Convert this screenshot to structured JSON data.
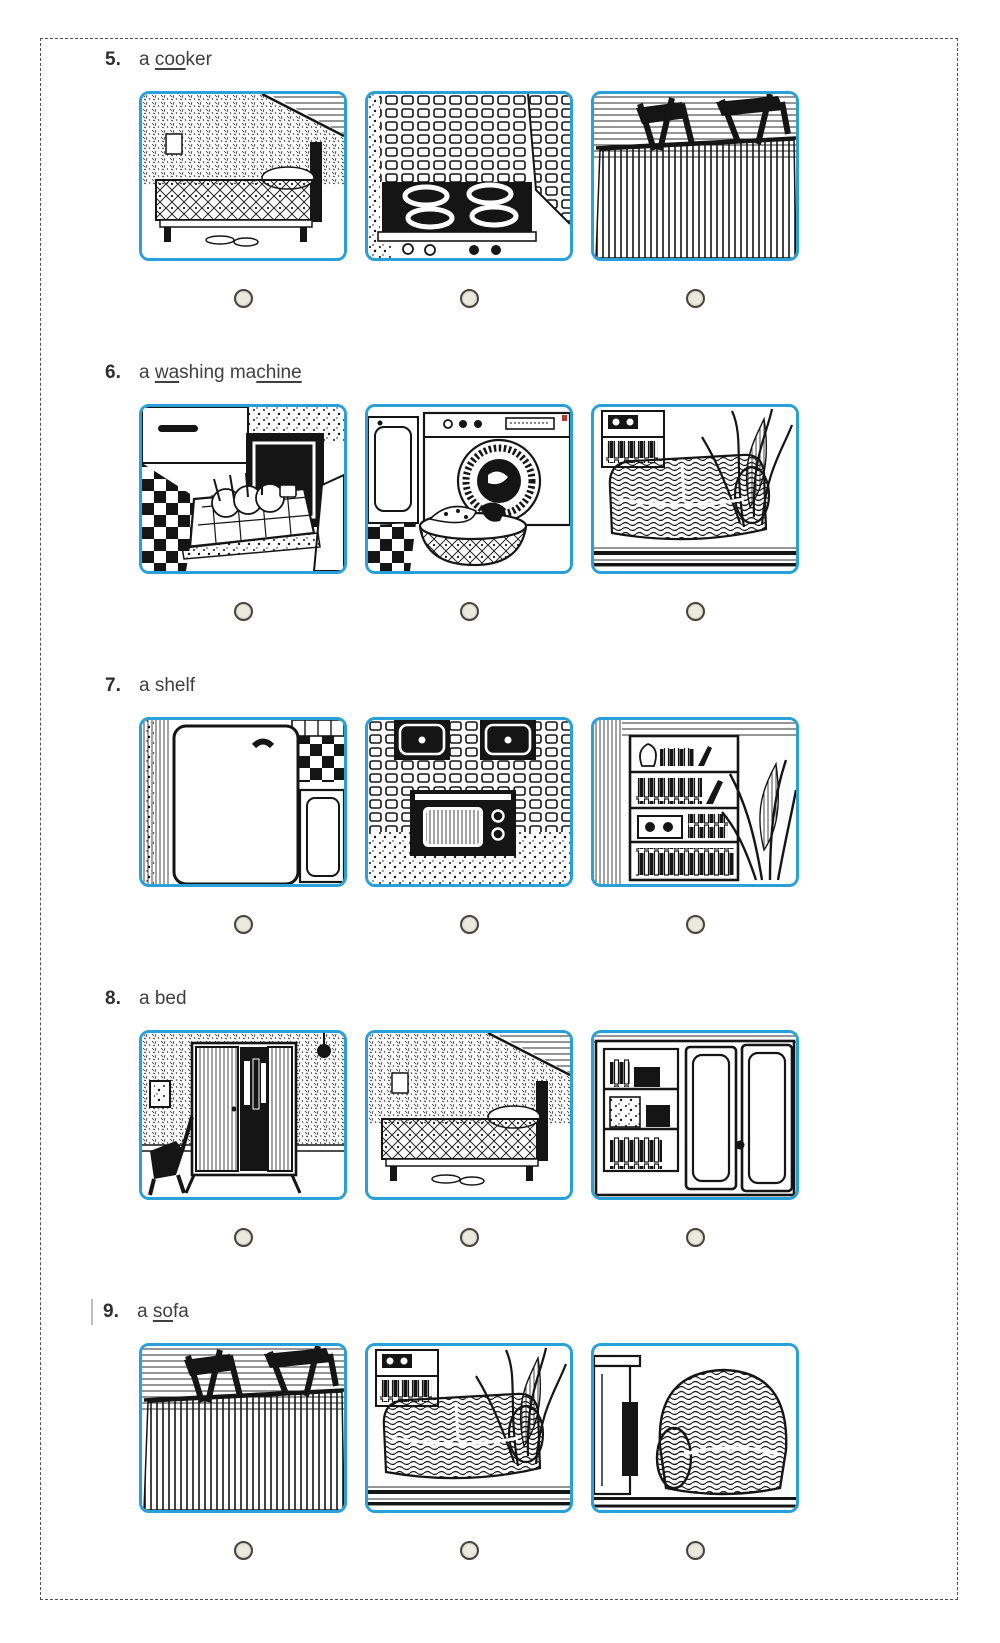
{
  "page": {
    "background": "#ffffff",
    "frame_border_color": "#4f4f4f",
    "image_border_color": "#2aa0d8",
    "radio_fill_color": "#eceade",
    "radio_border_color": "#45443e",
    "ink_color": "#151515"
  },
  "questions": [
    {
      "number": "5",
      "caret": false,
      "label_parts": [
        {
          "text": "a ",
          "underline": false
        },
        {
          "text": "coo",
          "underline": true
        },
        {
          "text": "ker",
          "underline": false
        }
      ],
      "options": [
        {
          "image": "bedroom-bed",
          "label": "bedroom with a bed",
          "selected": false
        },
        {
          "image": "cooker-hob",
          "label": "kitchen cooker hob",
          "selected": false
        },
        {
          "image": "dining-table",
          "label": "table and chairs",
          "selected": false
        }
      ]
    },
    {
      "number": "6",
      "caret": false,
      "label_parts": [
        {
          "text": "a ",
          "underline": false
        },
        {
          "text": "wa",
          "underline": true
        },
        {
          "text": "shing ma",
          "underline": false
        },
        {
          "text": "chine",
          "underline": true
        }
      ],
      "options": [
        {
          "image": "dishwasher",
          "label": "dishwasher with dish rack",
          "selected": false
        },
        {
          "image": "washing-machine",
          "label": "washing machine with laundry basket",
          "selected": false
        },
        {
          "image": "sofa-plant",
          "label": "sofa with plant",
          "selected": false
        }
      ]
    },
    {
      "number": "7",
      "caret": false,
      "label_parts": [
        {
          "text": "a shelf",
          "underline": false
        }
      ],
      "options": [
        {
          "image": "fridge",
          "label": "refrigerator",
          "selected": false
        },
        {
          "image": "oven",
          "label": "built-in oven in tiled wall",
          "selected": false
        },
        {
          "image": "bookshelf",
          "label": "bookshelf with books and stereo",
          "selected": false
        }
      ]
    },
    {
      "number": "8",
      "caret": false,
      "label_parts": [
        {
          "text": "a bed",
          "underline": false
        }
      ],
      "options": [
        {
          "image": "wardrobe",
          "label": "open wardrobe with clothes",
          "selected": false
        },
        {
          "image": "bedroom-bed",
          "label": "bedroom with a bed",
          "selected": false
        },
        {
          "image": "cupboard",
          "label": "cupboard with shelves",
          "selected": false
        }
      ]
    },
    {
      "number": "9",
      "caret": true,
      "label_parts": [
        {
          "text": "a ",
          "underline": false
        },
        {
          "text": "so",
          "underline": true
        },
        {
          "text": "fa",
          "underline": false
        }
      ],
      "options": [
        {
          "image": "dining-table",
          "label": "table and chairs",
          "selected": false
        },
        {
          "image": "sofa-plant",
          "label": "sofa with plant",
          "selected": false
        },
        {
          "image": "armchair",
          "label": "armchair by fireplace",
          "selected": false
        }
      ]
    }
  ]
}
